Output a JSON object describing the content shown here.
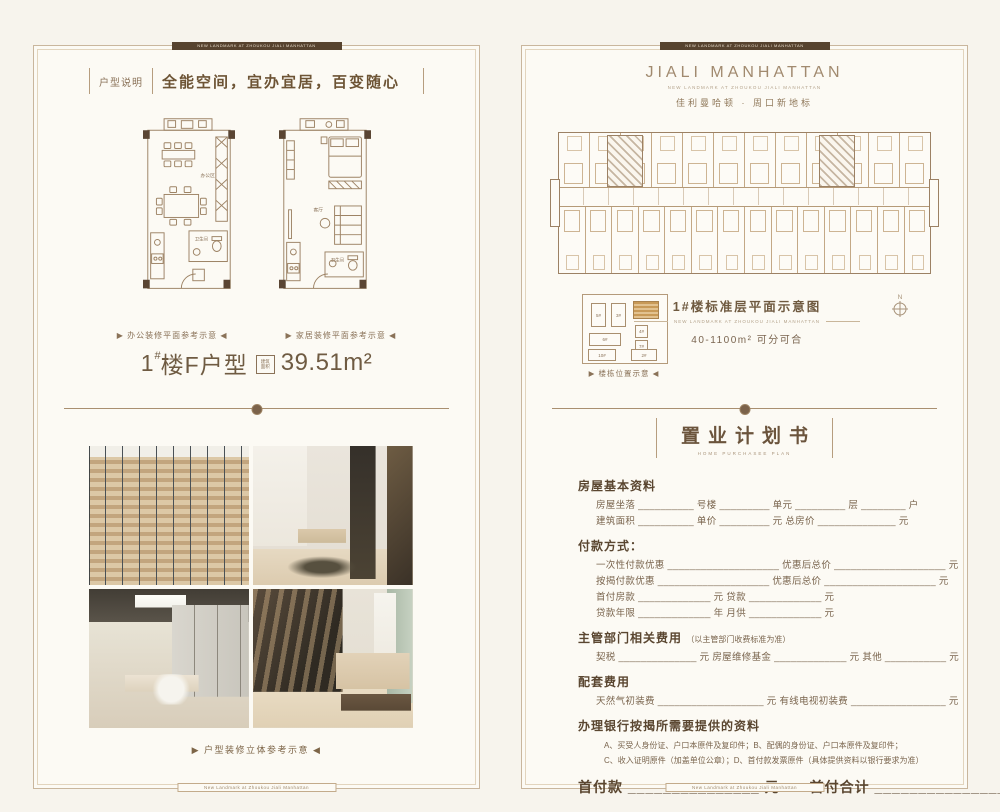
{
  "frame": {
    "top_text": "NEW LANDMARK AT ZHOUKOU JIALI MANHATTAN",
    "bottom_text": "New Landmark at Zhoukou Jiali Manhattan"
  },
  "colors": {
    "accent": "#6f5940",
    "line": "#c7b49c",
    "dark_bar": "#57432f",
    "highlight": "#c89a58"
  },
  "left_page": {
    "badge": "户型说明",
    "slogan": "全能空间，宜办宜居，百变随心",
    "plans": [
      {
        "caption": "▶ 办公装修平面参考示意 ◀",
        "labels": [
          "办公区",
          "卫生间"
        ]
      },
      {
        "caption": "▶ 家居装修平面参考示意 ◀",
        "labels": [
          "客厅",
          "卫生间"
        ]
      }
    ],
    "unit": {
      "num": "1",
      "sup": "#",
      "rest": "楼F户型",
      "area_label_1": "建筑",
      "area_label_2": "面积",
      "area_value": "39.51m²"
    },
    "photos": [
      "office-reception",
      "study-room",
      "meeting-room",
      "bedroom"
    ],
    "photos_caption": "▶ 户型装修立体参考示意 ◀"
  },
  "right_page": {
    "brand": {
      "title": "JIALI MANHATTAN",
      "subtitle": "NEW LANDMARK AT ZHOUKOU JIALI MANHATTAN",
      "cn": "佳利曼哈顿 · 周口新地标"
    },
    "building_plan": {
      "units_top": 12,
      "units_bottom": 14
    },
    "plan_caption": {
      "title": "1#楼标准层平面示意图",
      "subtitle": "NEW LANDMARK AT ZHOUKOU JIALI MANHATTAN",
      "range": "40-1100m² 可分可合"
    },
    "site_map": {
      "caption": "▶ 楼栋位置示意 ◀",
      "blocks": [
        "5#",
        "3#",
        "6#",
        "4#",
        "7#",
        "10#",
        "2#"
      ]
    },
    "compass_label": "N",
    "form": {
      "title": "置业计划书",
      "subtitle": "HOME PURCHASEE PLAN",
      "s1_heading": "房屋基本资料",
      "s1_rows": [
        "房屋坐落 __________ 号楼 _________ 单元 _________ 层 ________ 户",
        "建筑面积 __________ 单价 _________ 元 总房价 ______________ 元"
      ],
      "s2_heading": "付款方式：",
      "s2_rows": [
        "一次性付款优惠 ____________________ 优惠后总价 ____________________ 元",
        "按揭付款优惠 ____________________ 优惠后总价 ____________________ 元",
        "首付房款 _____________ 元 贷款 _____________ 元",
        "贷款年限 _____________ 年 月供 _____________ 元"
      ],
      "s3_heading": "主管部门相关费用",
      "s3_note": "（以主管部门收费标准为准）",
      "s3_rows": [
        "契税 ______________ 元 房屋维修基金 _____________ 元 其他 ___________ 元"
      ],
      "s4_heading": "配套费用",
      "s4_rows": [
        "天然气初装费 ___________________ 元 有线电视初装费 _________________ 元"
      ],
      "s5_heading": "办理银行按揭所需要提供的资料",
      "s5_rows": [
        "A、买受人身份证、户口本原件及复印件；B、配偶的身份证、户口本原件及复印件；",
        "C、收入证明原件（加盖单位公章）；D、首付款发票原件（具体提供资料以银行要求为准）"
      ],
      "total_row": "首付款 _______________ 元　　首付合计 _______________ 元",
      "footer_row": "置业顾问 ____________ 联系方式 _________________ 日期 _____ 年 ____ 月 ____ 日"
    }
  }
}
